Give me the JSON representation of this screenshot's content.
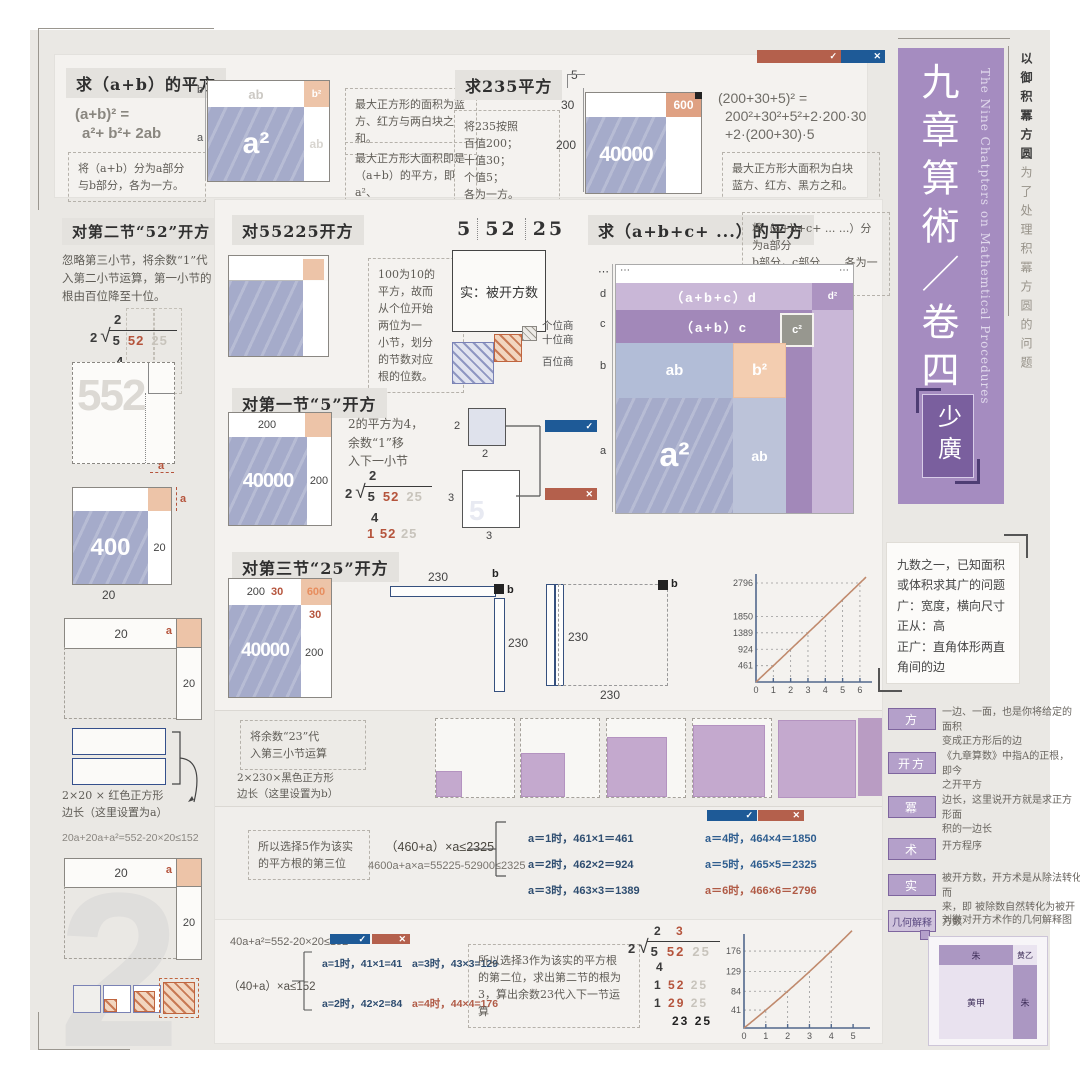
{
  "lab": {
    "a": "a",
    "b": "b",
    "dots": "⋯",
    "check": "✓",
    "cross": "✕",
    "n2": "2",
    "n3": "3",
    "n5": "5",
    "n20": "20",
    "n30": "30",
    "n200": "200",
    "n230": "230",
    "n400": "400",
    "n552": "552",
    "n600": "600",
    "n40000": "40000",
    "ab": "ab",
    "a2": "a²",
    "b2": "b²",
    "c2": "c²",
    "d2": "d²",
    "abc_d": "（a+b+c）d",
    "ab_c": "（a+b）c",
    "d": "d",
    "c": "c"
  },
  "top": {
    "sec_ab": {
      "title": "求（a+b）的平方",
      "f1": "(a+b)² =",
      "f2": "a²+ b²+ 2ab",
      "note": "将（a+b）分为a部分\n与b部分，各为一方。"
    },
    "note_blue": "最大正方形的面积为蓝\n方、红方与两白块之和。",
    "note_max": "最大正方形大面积即是\n（a+b）的平方，即a²、\nb²、ab、ab之和",
    "sec235": {
      "title": "求235平方",
      "note": "将235按照\n百值200；\n十值30；\n个值5；\n各为一方。"
    },
    "eq235_l1": "(200+30+5)² =",
    "eq235_l2": "200²+30²+5²+2·200·30",
    "eq235_l3": "+2·(200+30)·5",
    "note_white": "最大正方形大面积为白块\n蓝方、红方、黑方之和。"
  },
  "left": {
    "sec52_title": "对第二节“52”开方",
    "sec52_note": "忽略第三小节，将余数“1”代\n入第二小节运算，第一小节的\n根由百位降至十位。",
    "brace_note": "2×20 × 红色正方形\n边长（这里设置为a）",
    "ineq": "20a+20a+a²=552-20×20≤152"
  },
  "division": {
    "q1": "2",
    "q2": "3",
    "pre": "2",
    "g5": "5",
    "g52": "52",
    "g25": "25",
    "g4": "4",
    "g1": "1",
    "g29": "29",
    "g23": "23"
  },
  "mid": {
    "sec55225_title": "对55225开方",
    "sec55225_note": "100为10的\n平方，故而\n从个位开始\n两位为一\n小节，划分\n的节数对应\n根的位数。",
    "shi": "实：被开方数",
    "legend_ge": "个位商",
    "legend_shi": "十位商",
    "legend_bai": "百位商",
    "sec5_title": "对第一节“5”开方",
    "sec5_note": "2的平方为4，\n余数“1”移\n入下一小节",
    "secabc_title": "求（a+b+c+ ...）的平方",
    "secabc_note": "将（a+b+c+ ... ...）分为a部分\nb部分，c部分... ...各为一方。",
    "sec25_title": "对第三节“25”开方",
    "band1_note1": "将余数“23”代\n入第三小节运算",
    "band1_note2": "2×230×黑色正方形\n边长（这里设置为b）",
    "band2_note": "所以选择5作为该实\n的平方根的第三位",
    "band2_eq1": "（460+a）×a≤2325",
    "band2_eq2": "4600a+a×a=55225-52900≤2325",
    "cases_l": [
      "a＝1时，461×1＝461",
      "a＝2时，462×2＝924",
      "a＝3时，463×3＝1389"
    ],
    "cases_r": [
      "a＝4时，464×4＝1850",
      "a＝5时，465×5＝2325",
      "a＝6时，466×6＝2796"
    ]
  },
  "bottom": {
    "eq1": "40a+a²=552-20×20≤152",
    "eq2": "（40+a）×a≤152",
    "case1": "a=1时，41×1=41",
    "case2": "a=3时，43×3=129",
    "case3": "a=2时，42×2=84",
    "case4": "a=4时，44×4=176",
    "note": "所以选择3作为该实的平方根\n的第二位，求出第二节的根为\n3，算出余数23代入下一节运算"
  },
  "sidebar": {
    "title_cn": "九章算術／卷四",
    "title_en": "The Nine Chatpters on Mathemtical Procedures",
    "badge": "少廣",
    "tag_bold": "以御积冪方圆",
    "tag_rest": "为了处理积冪方圆的问题"
  },
  "right": {
    "infobox": "九数之一，已知面积\n或体积求其广的问题\n广：宽度，横向尺寸\n正从：高\n正广：直角体形两直\n角间的边",
    "glossary": [
      {
        "term": "方",
        "desc": "一边、一面，也是你将给定的面积\n变成正方形后的边"
      },
      {
        "term": "开方",
        "desc": "《九章算数》中指A的正根，即今\n之开平方"
      },
      {
        "term": "冪",
        "desc": "边长，这里说开方就是求正方形面\n积的一边长"
      },
      {
        "term": "术",
        "desc": "开方程序"
      },
      {
        "term": "实",
        "desdesc": "",
        "desc": "被开方数，开方术是从除法转化而\n来，即 被除数自然转化为被开方数"
      },
      {
        "term": "几何解释",
        "desc": "刘徽对开方术作的几何解释图"
      }
    ],
    "geo": {
      "zhu_top": "朱",
      "huang_yi": "黄乙",
      "huang_jia": "黄甲",
      "zhu_right": "朱"
    }
  },
  "watermarks": {
    "w1": "1",
    "w2": "2",
    "w3": "3"
  },
  "chart_data": [
    {
      "type": "line",
      "title": "余数2325与(460+a)×a的比较",
      "x": [
        0,
        1,
        2,
        3,
        4,
        5,
        6
      ],
      "series": [
        {
          "name": "(460+a)·a",
          "values": [
            0,
            461,
            924,
            1389,
            1850,
            2325,
            2796
          ]
        }
      ],
      "xticks": [
        0,
        1,
        2,
        3,
        4,
        5,
        6
      ],
      "yticks": [
        461,
        924,
        1389,
        1850,
        2796
      ],
      "xlim": [
        0,
        6.35
      ],
      "ylim": [
        0,
        3050
      ],
      "curve_coef": [
        0,
        460,
        1
      ],
      "ml": 34,
      "xlabel": "a",
      "ylabel": "(460+a)×a",
      "legend": "none",
      "grid": "dashed-guides"
    },
    {
      "type": "line",
      "title": "余数152与(40+a)×a的比较",
      "x": [
        0,
        1,
        2,
        3,
        4,
        5
      ],
      "series": [
        {
          "name": "(40+a)·a",
          "values": [
            0,
            41,
            84,
            129,
            176,
            225
          ]
        }
      ],
      "xticks": [
        0,
        1,
        2,
        3,
        4,
        5
      ],
      "yticks": [
        41,
        84,
        129,
        176
      ],
      "xlim": [
        0,
        5.5
      ],
      "ylim": [
        0,
        215
      ],
      "curve_coef": [
        0,
        40,
        1
      ],
      "ml": 28,
      "xlabel": "a",
      "ylabel": "(40+a)×a",
      "legend": "none",
      "grid": "dashed-guides"
    }
  ]
}
